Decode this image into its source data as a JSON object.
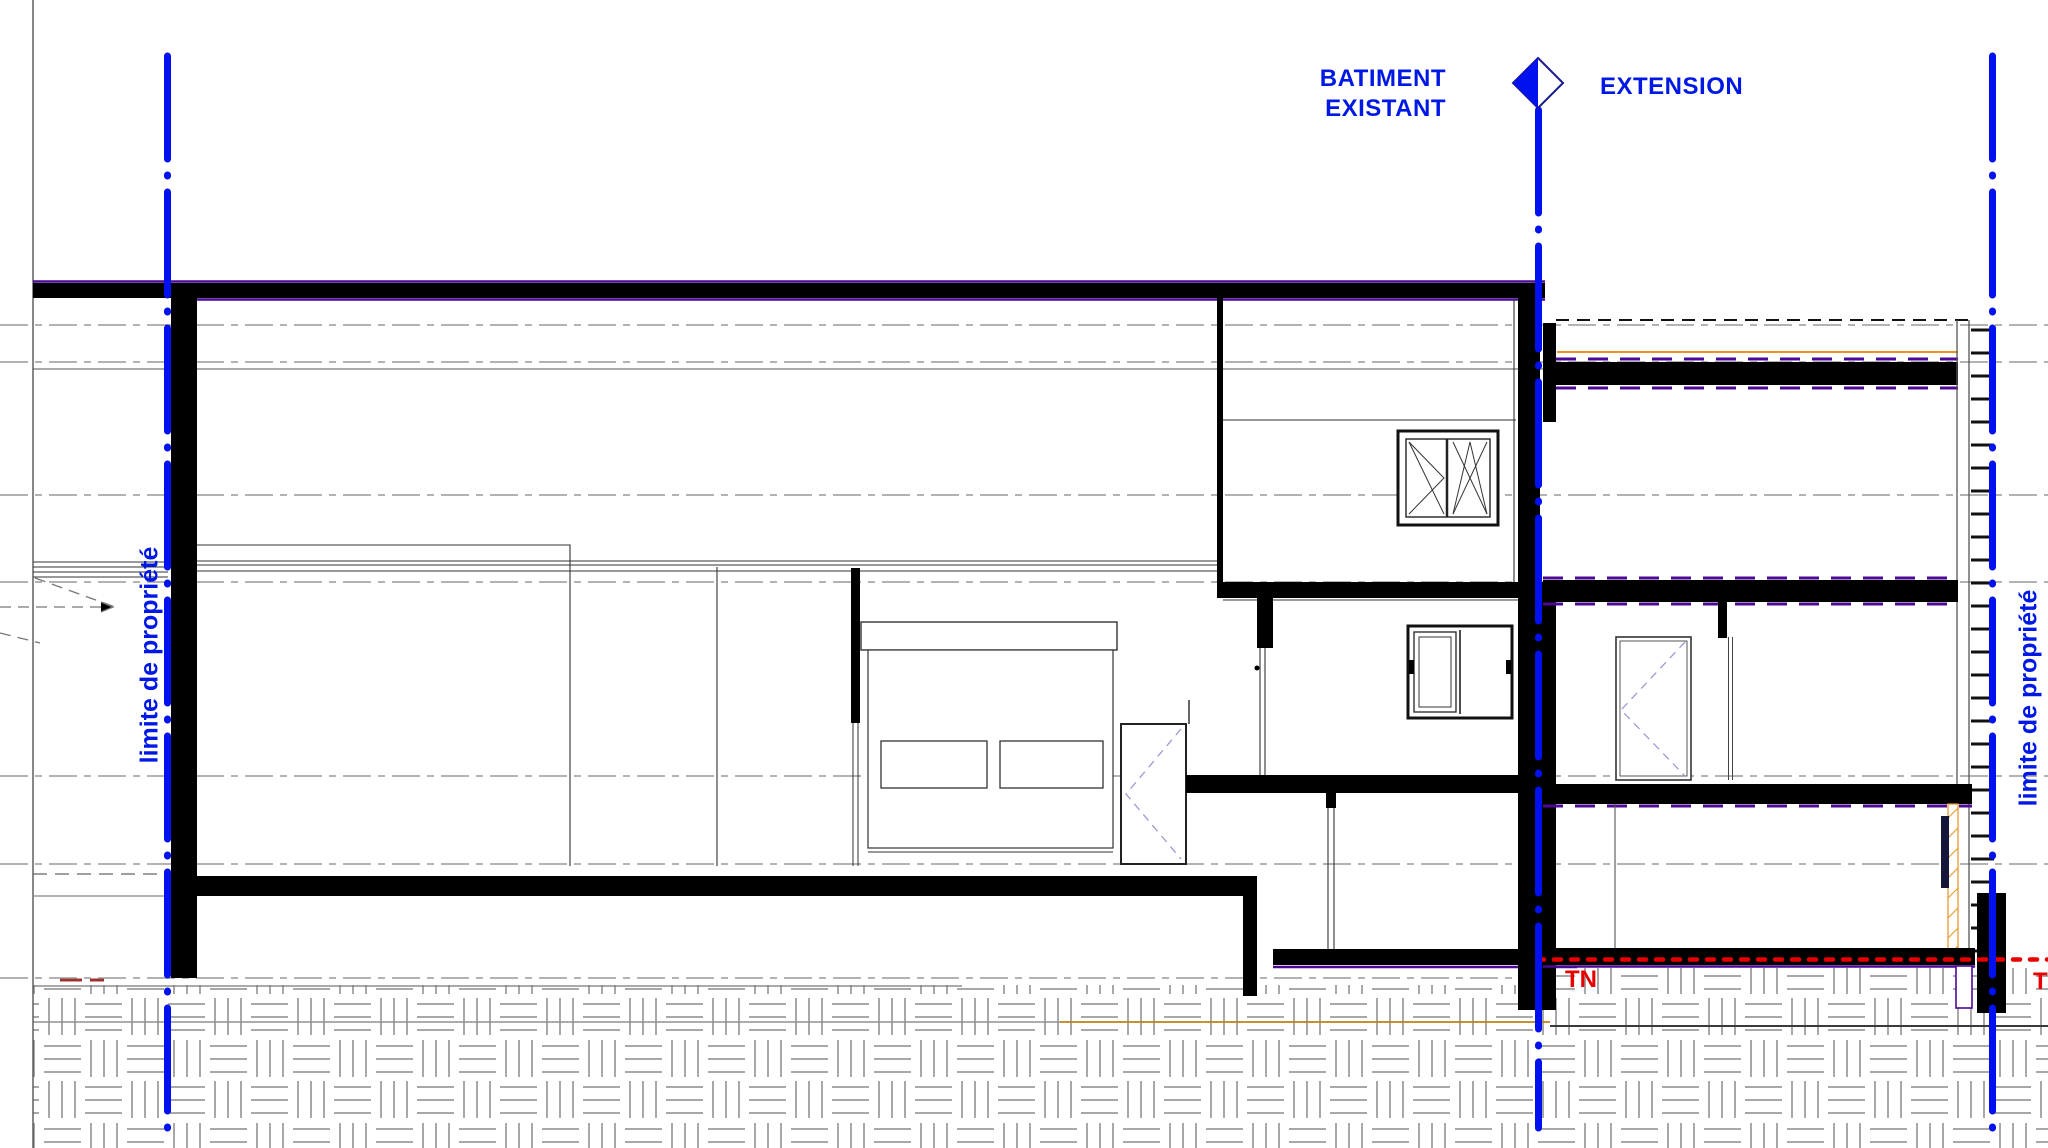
{
  "title": "Coupe - batiment existant et extension",
  "labels": {
    "building_left_line1": "BATIMENT",
    "building_left_line2": "EXISTANT",
    "building_right": "EXTENSION",
    "property_limit_left": "limite de propriété",
    "property_limit_right": "limite de propriété",
    "terrain_naturel_1": "TN",
    "terrain_naturel_2": "TN"
  },
  "colors": {
    "axis_blue": "#0011EF",
    "label_blue": "#0018E6",
    "tn_red": "#E80000",
    "slab_purple": "#4B0996",
    "accent_orange": "#E8941F",
    "level_line_gray": "#9a9a9a",
    "ink_black": "#000000"
  },
  "icons": {
    "section_axis_marker": "half-filled-diamond"
  }
}
